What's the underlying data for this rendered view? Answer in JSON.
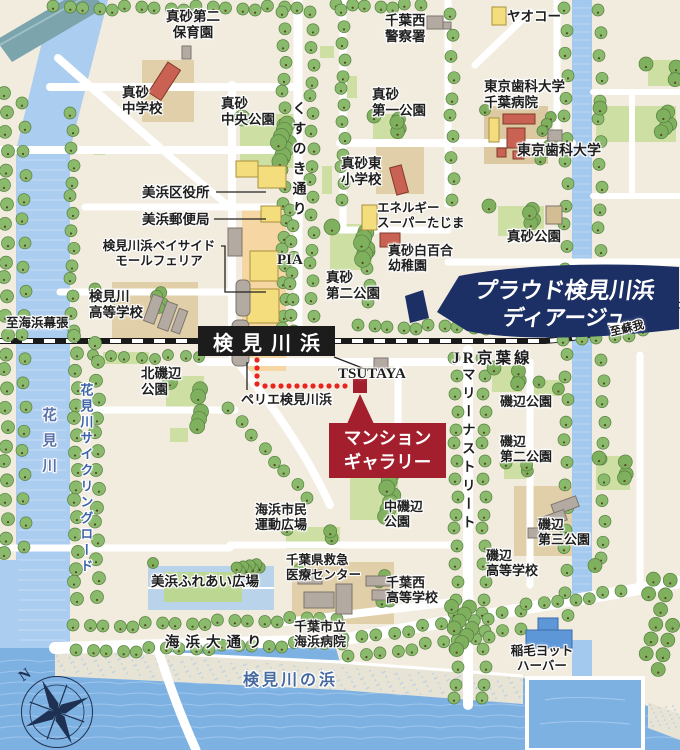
{
  "labels": {
    "masago_daini_hoikuen": "真砂第二\n保育園",
    "masago_chugakko": "真砂\n中学校",
    "masago_chuo_koen": "真砂\n中央公園",
    "chiba_nishi_keisatsusho": "千葉西\n警察署",
    "yaoko": "ヤオコー",
    "masago_daiichi_koen": "真砂\n第一公園",
    "tokyo_shika_chiba_byoin": "東京歯科大学\n千葉病院",
    "tokyo_shika_daigaku": "東京歯科大学",
    "masago_higashi_shogakko": "真砂東\n小学校",
    "kusunoki_dori": "くすのき通り",
    "mihama_kuyakusho": "美浜区役所",
    "mihama_yubinkyoku": "美浜郵便局",
    "bayside_mall": "検見川浜ベイサイド\nモールフェリア",
    "pia": "PIA",
    "energy_super_tajima": "エネルギー\nスーパーたじま",
    "masago_shirayuri_yochien": "真砂白百合\n幼稚園",
    "masago_koen": "真砂公園",
    "masago_daini_koen": "真砂\n第二公園",
    "kemigawa_kotogakko": "検見川\n高等学校",
    "station": "検見川浜",
    "jr_keiyo_line": "JR京葉線",
    "to_soga": "至蘇我",
    "to_kaihimmakuhari": "至海浜幕張",
    "tsutaya": "TSUTAYA",
    "perie_kemigawahama": "ペリエ検見川浜",
    "kita_isobe_koen": "北磯辺\n公園",
    "proud_line1": "プラウド検見川浜",
    "proud_line2": "ディアージュ",
    "mansion_gallery": "マンション\nギャラリー",
    "hanamigawa": "花見川",
    "cycling_road": "花見川サイクリングロード",
    "marina_street": "マリーナストリート",
    "isobe_koen": "磯辺公園",
    "isobe_daini_koen": "磯辺\n第二公園",
    "isobe_daisan_koen": "磯辺\n第三公園",
    "isobe_kotogakko": "磯辺\n高等学校",
    "naka_isobe_koen": "中磯辺\n公園",
    "kaihin_shimin_hiroba": "海浜市民\n運動広場",
    "chiba_kyukyu_center": "千葉県救急\n医療センター",
    "chiba_nishi_kotogakko": "千葉西\n高等学校",
    "mihama_fureai_hiroba": "美浜ふれあい広場",
    "chiba_kaihin_byoin": "千葉市立\n海浜病院",
    "kaihin_odori": "海浜大通り",
    "kemigawa_no_hama": "検見川の浜",
    "inage_yacht_harbor": "稲毛ヨット\nハーバー",
    "compass_north": "N"
  },
  "colors": {
    "brand_navy": "#1d3065",
    "gallery_red": "#a31f2d",
    "route_red": "#e8251f",
    "sea": "#7db1e2",
    "river": "#abcdf0",
    "tree_green": "#8aba6b",
    "park_green": "#cddfa3",
    "rail_black": "#1a1a1a",
    "station_street": "#f6d6a2"
  }
}
